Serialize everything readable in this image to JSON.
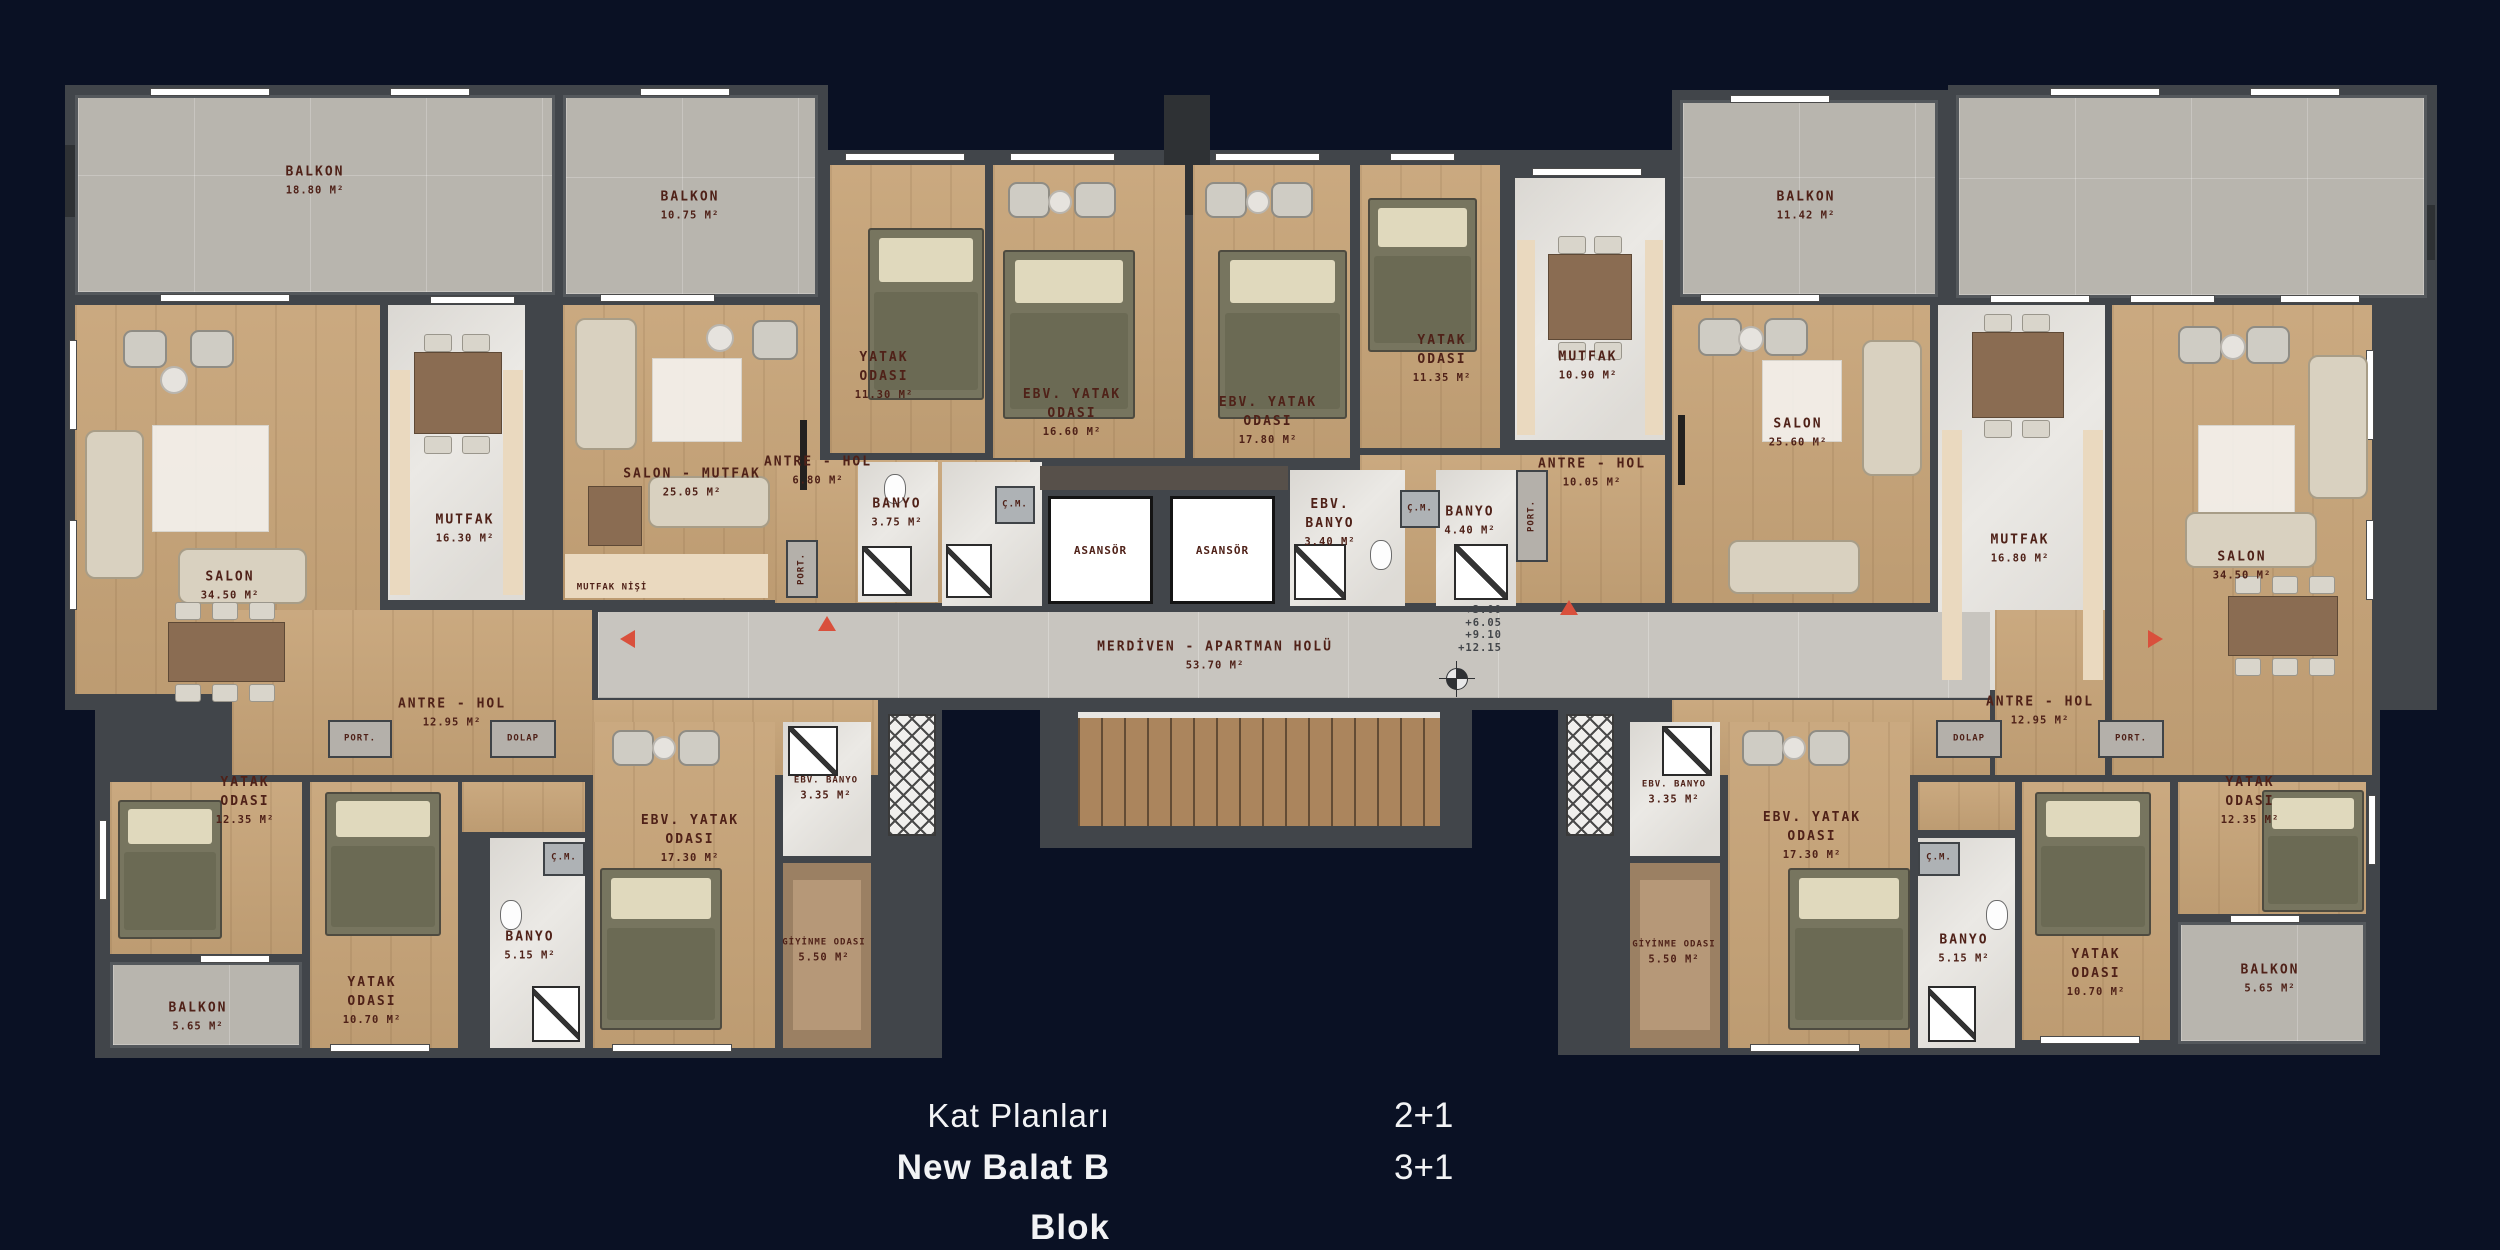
{
  "plan": {
    "labels": {
      "balkon_1880": {
        "n": "BALKON",
        "a": "18.80 M²"
      },
      "balkon_1075": {
        "n": "BALKON",
        "a": "10.75 M²"
      },
      "balkon_1142": {
        "n": "BALKON",
        "a": "11.42 M²"
      },
      "balkon_565": {
        "n": "BALKON",
        "a": "5.65 M²"
      },
      "salon_3450": {
        "n": "SALON",
        "a": "34.50 M²"
      },
      "salon_2560": {
        "n": "SALON",
        "a": "25.60 M²"
      },
      "salon_mutfak_2505": {
        "n": "SALON - MUTFAK",
        "a": "25.05 M²"
      },
      "mutfak_1630": {
        "n": "MUTFAK",
        "a": "16.30 M²"
      },
      "mutfak_1090": {
        "n": "MUTFAK",
        "a": "10.90 M²"
      },
      "mutfak_1680": {
        "n": "MUTFAK",
        "a": "16.80 M²"
      },
      "mutfak_nisi": {
        "n": "MUTFAK NİŞİ"
      },
      "yatak_1130": {
        "n": "YATAK ODASI",
        "a": "11.30 M²"
      },
      "yatak_1135": {
        "n": "YATAK ODASI",
        "a": "11.35 M²"
      },
      "yatak_1235": {
        "n": "YATAK ODASI",
        "a": "12.35 M²"
      },
      "yatak_1070": {
        "n": "YATAK ODASI",
        "a": "10.70 M²"
      },
      "ebv_1660": {
        "n": "EBV. YATAK ODASI",
        "a": "16.60 M²"
      },
      "ebv_1780": {
        "n": "EBV. YATAK ODASI",
        "a": "17.80 M²"
      },
      "ebv_1730": {
        "n": "EBV. YATAK ODASI",
        "a": "17.30 M²"
      },
      "antre_680": {
        "n": "ANTRE - HOL",
        "a": "6.80 M²"
      },
      "antre_1005": {
        "n": "ANTRE - HOL",
        "a": "10.05 M²"
      },
      "antre_1295": {
        "n": "ANTRE - HOL",
        "a": "12.95 M²"
      },
      "banyo_375": {
        "n": "BANYO",
        "a": "3.75 M²"
      },
      "banyo_440": {
        "n": "BANYO",
        "a": "4.40 M²"
      },
      "banyo_515": {
        "n": "BANYO",
        "a": "5.15 M²"
      },
      "ebv_banyo_340": {
        "n": "EBV. BANYO",
        "a": "3.40 M²"
      },
      "ebv_banyo_335": {
        "n": "EBV. BANYO",
        "a": "3.35 M²"
      },
      "giyinme_550": {
        "n": "GİYİNME ODASI",
        "a": "5.50 M²"
      },
      "cm": {
        "n": "Ç.M."
      },
      "port": {
        "n": "PORT."
      },
      "dolap": {
        "n": "DOLAP"
      }
    },
    "core": {
      "asansor": "ASANSÖR",
      "merdiven": "MERDİVEN - APARTMAN HOLÜ",
      "merdiven_area": "53.70 M²",
      "elevations": [
        "+3.00",
        "+6.05",
        "+9.10",
        "+12.15"
      ]
    }
  },
  "caption": {
    "line1": "Kat Planları",
    "line2": "New Balat B Blok",
    "type1": "2+1",
    "type2": "3+1"
  }
}
